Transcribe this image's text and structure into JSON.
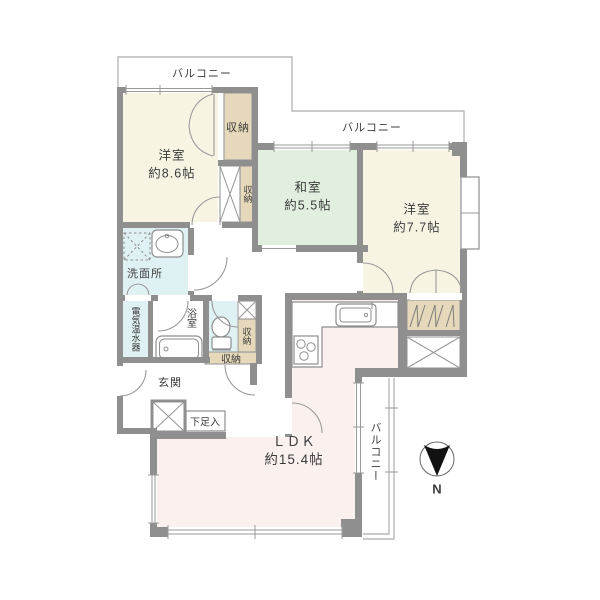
{
  "floorplan": {
    "rooms": [
      {
        "name": "洋室",
        "size": "約8.6帖"
      },
      {
        "name": "和室",
        "size": "約5.5帖"
      },
      {
        "name": "洋室",
        "size": "約7.7帖"
      },
      {
        "name": "ＬＤＫ",
        "size": "約15.4帖"
      }
    ],
    "labels": {
      "balcony_top_left": "バルコニー",
      "balcony_top_right": "バルコニー",
      "balcony_right": "バルコニー",
      "closet_top": "収納",
      "closet_mid": "収納",
      "closet_wc": "収納",
      "closet_hall": "収納",
      "washroom": "洗面所",
      "water_heater": "電気温水器",
      "bathroom": "浴室",
      "entrance": "玄関",
      "shoe_box": "下足入",
      "compass_n": "N"
    },
    "colors": {
      "wall": "#8f8f8f",
      "western_room": "#f7f4e3",
      "japanese_room": "#e1efdf",
      "wet_area": "#e0f1f4",
      "closet": "#e6d8ba",
      "ldk": "#faf0ee",
      "bathtub": "#d6edf2",
      "compass_arrow": "#111111"
    }
  }
}
